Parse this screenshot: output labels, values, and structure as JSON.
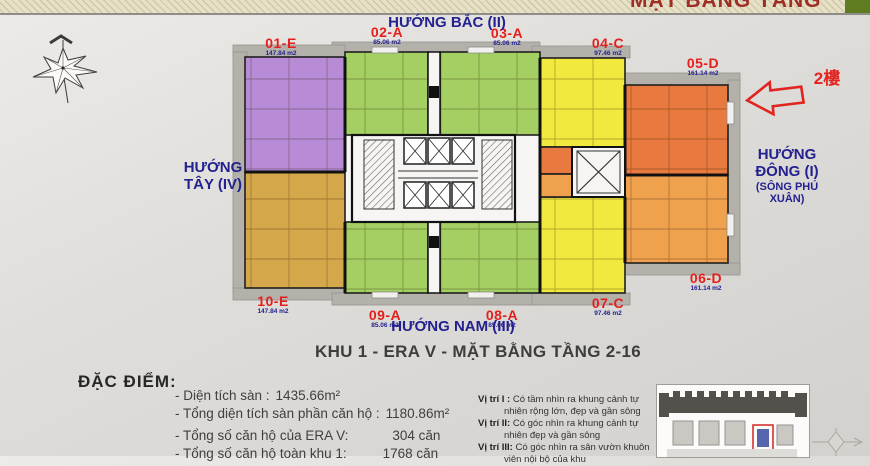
{
  "banner": {
    "title": "MẶT BẰNG TẦNG"
  },
  "directions": {
    "north": "HƯỚNG BẮC (II)",
    "west": "HƯỚNG TÂY (IV)",
    "east_line1": "HƯỚNG ĐÔNG (I)",
    "east_line2": "(SÔNG PHÚ XUÂN)",
    "south": "HƯỚNG NAM (III)"
  },
  "annotation": {
    "floor": "2樓"
  },
  "units": [
    {
      "code": "01-E",
      "area": "147.84 m2",
      "color": "purple"
    },
    {
      "code": "02-A",
      "area": "85.06 m2",
      "color": "green"
    },
    {
      "code": "03-A",
      "area": "85.06 m2",
      "color": "green"
    },
    {
      "code": "04-C",
      "area": "97.46 m2",
      "color": "yellow"
    },
    {
      "code": "05-D",
      "area": "161.14 m2",
      "color": "orange_dark"
    },
    {
      "code": "06-D",
      "area": "161.14 m2",
      "color": "orange_light"
    },
    {
      "code": "07-C",
      "area": "97.46 m2",
      "color": "yellow"
    },
    {
      "code": "08-A",
      "area": "85.06 m2",
      "color": "green"
    },
    {
      "code": "09-A",
      "area": "85.06 m2",
      "color": "green"
    },
    {
      "code": "10-E",
      "area": "147.84 m2",
      "color": "tan"
    }
  ],
  "plan_title": "KHU 1 - ERA V - MẶT BẰNG TẦNG 2-16",
  "features": {
    "heading": "ĐẶC ĐIỂM:",
    "items": [
      {
        "label": "- Diện tích sàn :",
        "value": "1435.66m²"
      },
      {
        "label": "- Tổng diện tích sàn phần căn hộ :",
        "value": "1180.86m²"
      },
      {
        "label": "- Tổng số căn hộ của ERA V:",
        "value": "304 căn"
      },
      {
        "label": "- Tổng số căn hộ toàn khu 1:",
        "value": "1768 căn"
      }
    ]
  },
  "viewpoints": {
    "items": [
      {
        "term": "Vị trí I :",
        "desc": "Có tầm nhìn ra khung cảnh tự nhiên rộng lớn, đẹp và gần sông"
      },
      {
        "term": "Vị trí II:",
        "desc": "Có góc nhìn ra khung cảnh tự nhiên đẹp và gần sông"
      },
      {
        "term": "Vị trí III:",
        "desc": "Có góc nhìn ra sân vườn khuôn viên nội bộ của khu"
      }
    ]
  },
  "icons": {
    "top_left": "compass-rose",
    "annotation_arrow": "left-arrow",
    "bottom_right": "compass-small",
    "thumbnail": "site-map"
  },
  "palette": {
    "purple": "#b78bd6",
    "green": "#a3cf63",
    "yellow": "#f1e93e",
    "orange_dark": "#e8793f",
    "orange_light": "#f0a14e",
    "tan": "#d5a74b",
    "band": "#b4b1ab",
    "code_red": "#e3201d",
    "navy": "#23218f",
    "anno_red": "#e02521",
    "banner_red": "#9e2f26",
    "banner_green": "#607c21"
  }
}
